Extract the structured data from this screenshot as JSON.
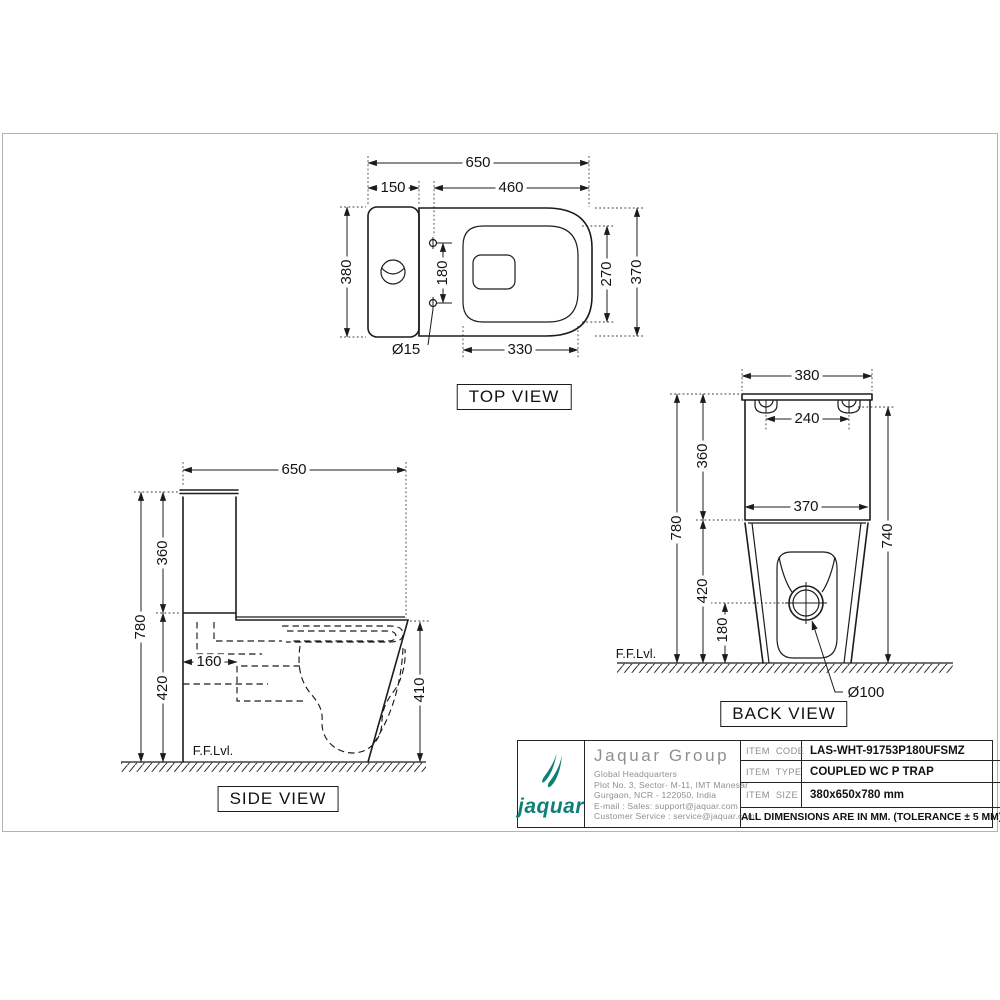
{
  "drawing": {
    "views": {
      "top": {
        "label": "TOP VIEW",
        "dim_overall_width": "650",
        "dim_tank_depth": "150",
        "dim_seat_length": "460",
        "dim_overall_depth": "380",
        "dim_hinge_hole_spacing": "180",
        "dim_inner_seat_depth": "270",
        "dim_bowl_depth": "370",
        "dim_inner_seat_width": "330",
        "dim_hinge_hole_dia": "Ø15"
      },
      "side": {
        "label": "SIDE VIEW",
        "dim_overall_length": "650",
        "dim_tank_height": "360",
        "dim_total_height": "780",
        "dim_bowl_height": "420",
        "dim_trap_offset": "160",
        "dim_rim_height": "410",
        "ffl": "F.F.Lvl."
      },
      "back": {
        "label": "BACK VIEW",
        "dim_lid_width": "380",
        "dim_fixing_hole_spacing": "240",
        "dim_tank_height": "360",
        "dim_tank_width": "370",
        "dim_total_height": "780",
        "dim_lid_underside_height": "740",
        "dim_bowl_height": "420",
        "dim_outlet_center_height": "180",
        "dim_outlet_dia": "Ø100",
        "ffl": "F.F.Lvl."
      }
    },
    "title_block": {
      "brand": {
        "logo_text": "jaquar",
        "color": "#0E8077"
      },
      "company_name": "Jaquar Group",
      "address_lines": [
        "Global Headquarters",
        "Plot No. 3, Sector- M-11, IMT Manesar",
        "Gurgaon, NCR - 122050, India",
        "E-mail : Sales: support@jaquar.com",
        "Customer Service : service@jaquar.com"
      ],
      "rows": [
        {
          "label": "ITEM CODE",
          "value": "LAS-WHT-91753P180UFSMZ"
        },
        {
          "label": "ITEM TYPE",
          "value": "COUPLED WC P TRAP"
        },
        {
          "label": "ITEM SIZE",
          "value": "380x650x780 mm"
        }
      ],
      "note": "ALL DIMENSIONS ARE IN MM. (TOLERANCE ± 5 MM)"
    }
  }
}
